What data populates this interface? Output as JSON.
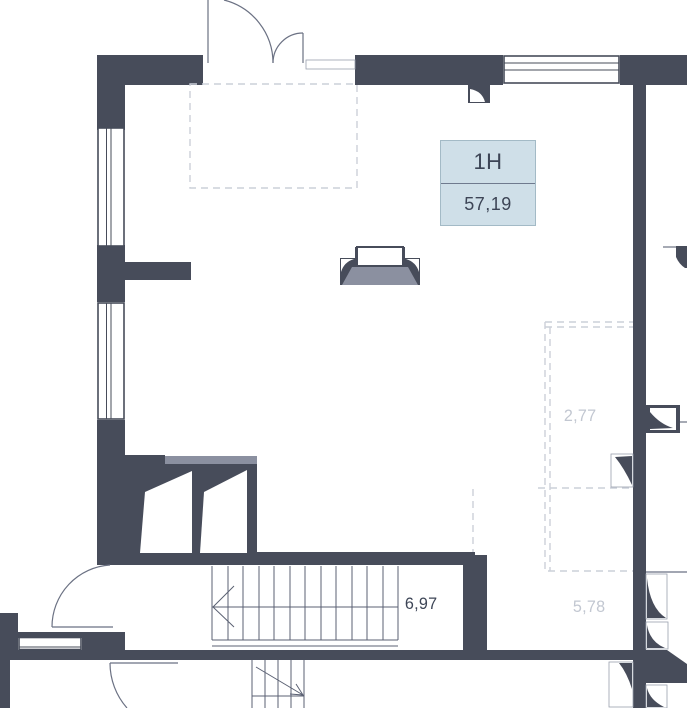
{
  "floorplan": {
    "unit": {
      "id": "1Н",
      "area": "57,19"
    },
    "rooms": [
      {
        "label": "2,77",
        "muted": true
      },
      {
        "label": "6,97",
        "muted": false
      },
      {
        "label": "5,78",
        "muted": true
      }
    ],
    "colors": {
      "wall": "#474c5a",
      "line": "#6b7183",
      "stair": "#5b6173",
      "dash": "#ccd0d9",
      "sill": "#8b90a0",
      "label_bg": "#cfdfe8",
      "label_border": "#a3bac6",
      "label_divider": "#6f7a8e",
      "text": "#3d4556",
      "faint_text": "#c2c7d1"
    }
  }
}
